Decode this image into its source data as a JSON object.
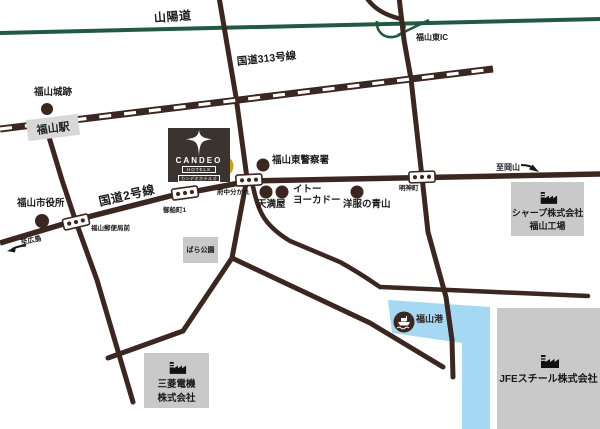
{
  "colors": {
    "road": "#3b2620",
    "expwy": "#1e5b40",
    "water": "#a5d8f2",
    "building": "#c9c9c9",
    "station": "#d8d8d8",
    "marker": "#c9a115",
    "logo": "#393430",
    "ink": "#191919"
  },
  "expressway": {
    "label": "山陽道",
    "ic_label": "福山東IC"
  },
  "roads": {
    "route313": "国道313号線",
    "route2": "国道2号線"
  },
  "railway": {
    "station": "福山駅"
  },
  "hotel": {
    "name": "CANDEO",
    "sub": "HOTELS",
    "kana": "カンデオホテルズ"
  },
  "landmarks": {
    "castle": "福山城跡",
    "police": "福山東警察署",
    "city_hall": "福山市役所",
    "tenmaya": "天満屋",
    "ito_1": "イトー",
    "ito_2": "ヨーカドー",
    "aoyama": "洋服の青山",
    "rose_park": "ばら公園",
    "sharp_1": "シャープ株式会社",
    "sharp_2": "福山工場",
    "mitsubishi_1": "三菱電機",
    "mitsubishi_2": "株式会社",
    "jfe": "JFEスチール株式会社",
    "port": "福山港"
  },
  "signals": {
    "post_office": "福山郵便局前",
    "mifunecho": "御船町1",
    "fuchu_wakare": "府中分かれ",
    "myojincho": "明神町"
  },
  "directions": {
    "to_hiroshima": "至広島",
    "to_okayama": "至岡山"
  }
}
